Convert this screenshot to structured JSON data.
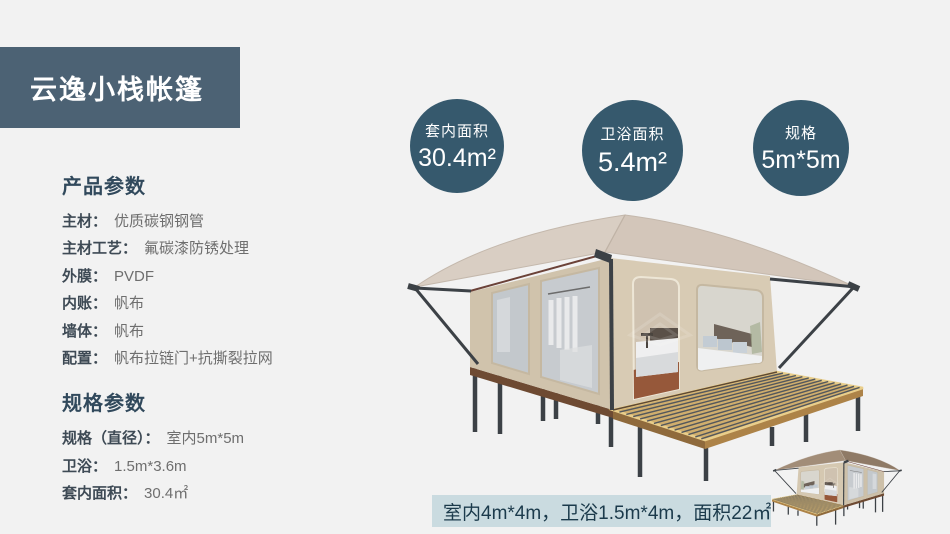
{
  "banner": {
    "title": "云逸小栈帐篷"
  },
  "product_params": {
    "heading": "产品参数",
    "rows": [
      {
        "label": "主材：",
        "value": "优质碳钢钢管"
      },
      {
        "label": "主材工艺：",
        "value": "氟碳漆防锈处理"
      },
      {
        "label": "外膜：",
        "value": "PVDF"
      },
      {
        "label": "内账：",
        "value": "帆布"
      },
      {
        "label": "墙体：",
        "value": "帆布"
      },
      {
        "label": "配置：",
        "value": "帆布拉链门+抗撕裂拉网"
      }
    ]
  },
  "spec_params": {
    "heading": "规格参数",
    "rows": [
      {
        "label": "规格（直径）：",
        "value": "室内5m*5m"
      },
      {
        "label": "卫浴：",
        "value": "1.5m*3.6m"
      },
      {
        "label": "套内面积：",
        "value": "30.4㎡"
      }
    ]
  },
  "badges": [
    {
      "label": "套内面积",
      "value": "30.4m²"
    },
    {
      "label": "卫浴面积",
      "value": "5.4m²"
    },
    {
      "label": "规格",
      "value": "5m*5m"
    }
  ],
  "footnote": {
    "text": "室内4m*4m，卫浴1.5m*4m，面积22㎡"
  },
  "colors": {
    "banner": "#4C6274",
    "badge": "#36596D",
    "footnote_bg": "#CADBE0",
    "heading_text": "#31495C"
  },
  "images": {
    "main_tent": "safari-glamping-tent-3d-render",
    "small_tent": "safari-glamping-tent-3d-render-small"
  }
}
